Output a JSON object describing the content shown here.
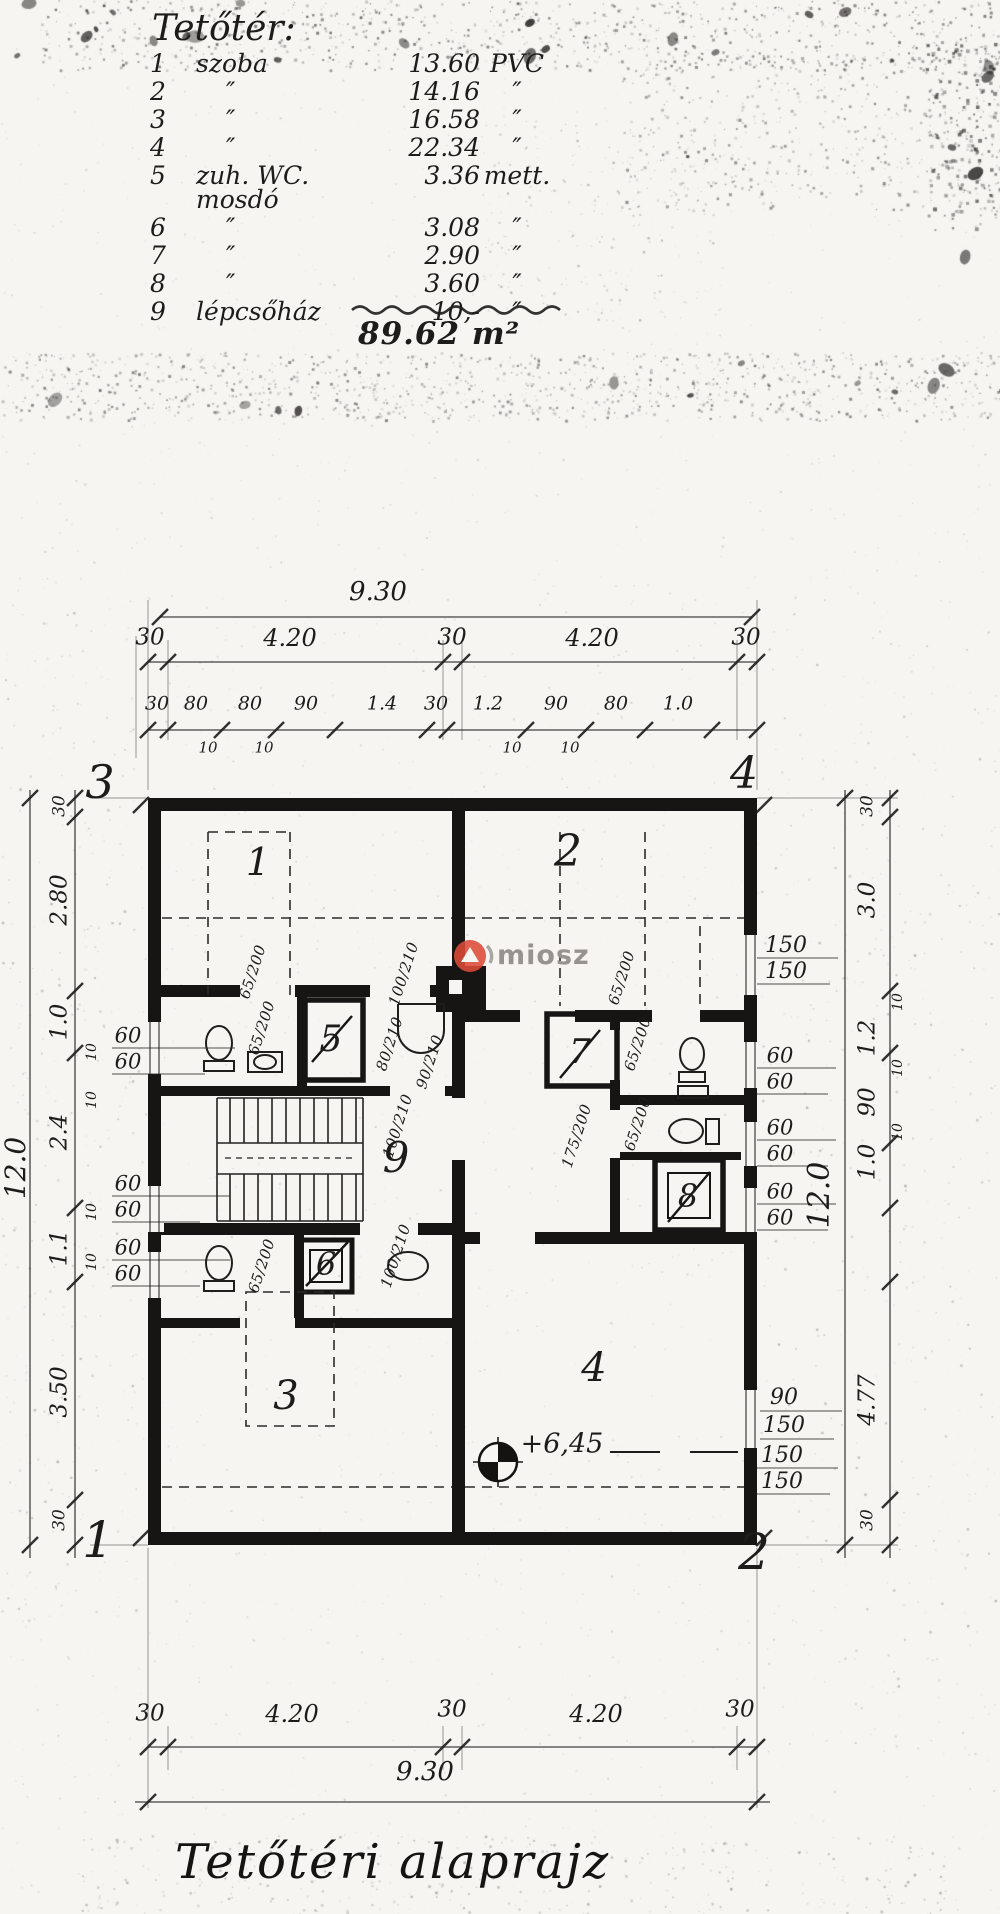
{
  "legend": {
    "title": "Tetőtér:",
    "rows": [
      {
        "num": "1",
        "name": "szoba",
        "area": "13.60",
        "floor": "PVC"
      },
      {
        "num": "2",
        "name": "″",
        "area": "14.16",
        "floor": "″"
      },
      {
        "num": "3",
        "name": "″",
        "area": "16.58",
        "floor": "″"
      },
      {
        "num": "4",
        "name": "″",
        "area": "22.34",
        "floor": "″"
      },
      {
        "num": "5",
        "name": "zuh. WC. mosdó",
        "area": "3.36",
        "floor": "mett."
      },
      {
        "num": "6",
        "name": "″",
        "area": "3.08",
        "floor": "″"
      },
      {
        "num": "7",
        "name": "″",
        "area": "2.90",
        "floor": "″"
      },
      {
        "num": "8",
        "name": "″",
        "area": "3.60",
        "floor": "″"
      },
      {
        "num": "9",
        "name": "lépcsőház",
        "area": "10,-",
        "floor": "″"
      }
    ],
    "total": "89.62 m²"
  },
  "dims": {
    "top": {
      "overall": "9.30",
      "row2": [
        "30",
        "4.20",
        "30",
        "4.20",
        "30"
      ],
      "row3": [
        "30",
        "80",
        "80",
        "90",
        "1.4",
        "30",
        "1.2",
        "90",
        "80",
        "1.0"
      ],
      "row3_sub": [
        "10",
        "10",
        "10",
        "10"
      ]
    },
    "bottom": {
      "row1": [
        "30",
        "4.20",
        "30",
        "4.20",
        "30"
      ],
      "overall": "9.30"
    },
    "left": {
      "overall": "12.0",
      "segments": [
        "30",
        "2.80",
        "1.0",
        "2.4",
        "1.1",
        "3.50",
        "30"
      ],
      "subs": [
        "10",
        "10",
        "10",
        "10"
      ]
    },
    "right": {
      "overall": "12.0",
      "segments": [
        "30",
        "3.0",
        "1.2",
        "90",
        "1.0",
        "4.77",
        "30"
      ],
      "subs": [
        "10",
        "10",
        "10"
      ]
    }
  },
  "plan": {
    "corners": {
      "tl": "3",
      "tr": "4",
      "bl": "1",
      "br": "2"
    },
    "rooms": [
      "1",
      "2",
      "5",
      "7",
      "9",
      "6",
      "8",
      "3",
      "4"
    ],
    "door_labels": [
      "65/200",
      "100/210",
      "80/210",
      "65/200",
      "90/210",
      "100/210",
      "100/210",
      "65/200",
      "65/200",
      "65/200",
      "65/200",
      "175/200"
    ],
    "window_labels_left": [
      [
        "60",
        "60"
      ],
      [
        "60",
        "60"
      ],
      [
        "60",
        "60"
      ]
    ],
    "window_labels_right": [
      [
        "150",
        "150"
      ],
      [
        "60",
        "60"
      ],
      [
        "60",
        "60"
      ],
      [
        "60",
        "60"
      ],
      [
        "90",
        "150"
      ],
      [
        "150",
        "150"
      ]
    ],
    "level_marker": "+6,45"
  },
  "watermark": {
    "text": "miosz"
  },
  "title": "Tetőtéri alaprajz",
  "colors": {
    "ink": "#1d1c1a",
    "paper": "#f6f5f2",
    "accent": "#dd4a38",
    "watermark_text": "#979390"
  }
}
